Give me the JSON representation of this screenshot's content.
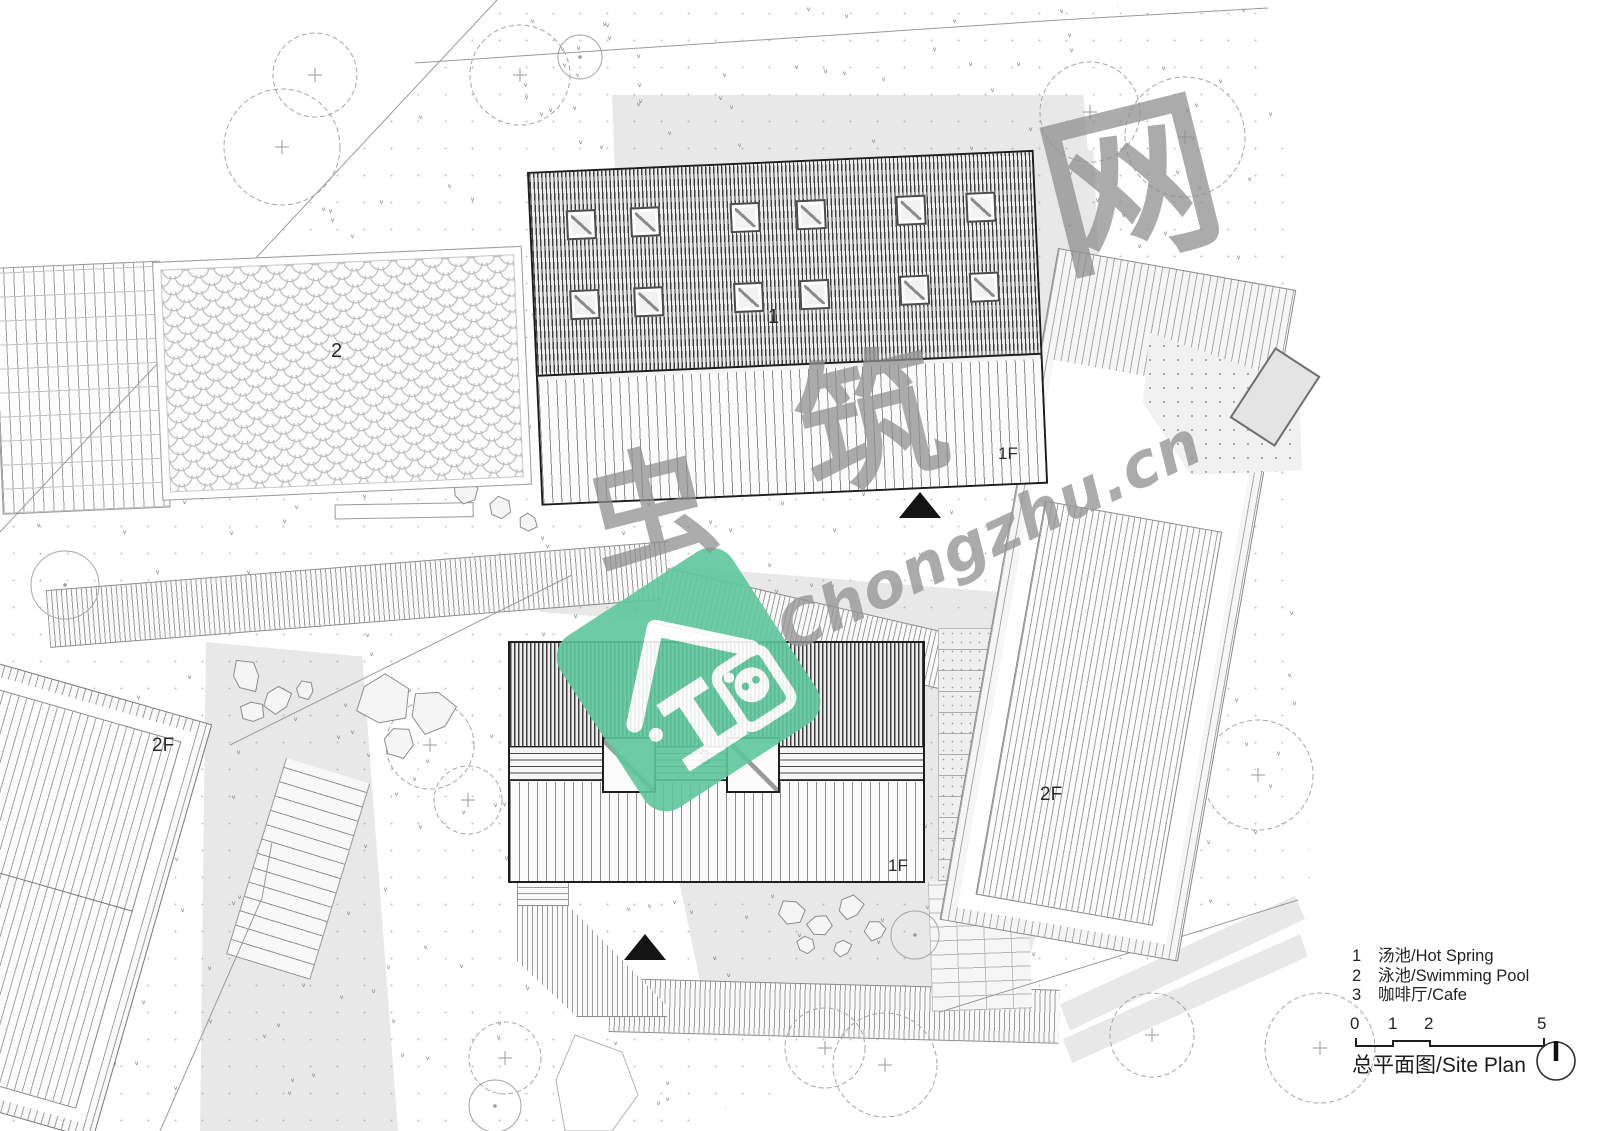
{
  "plan": {
    "buildings": {
      "hot_spring": {
        "number": "1",
        "floor": "1F"
      },
      "pool": {
        "number": "2"
      },
      "cafe": {
        "number": "3",
        "floor": "1F"
      },
      "west_building": {
        "floor": "2F"
      },
      "east_building": {
        "floor": "2F"
      }
    },
    "legend": {
      "items": [
        {
          "num": "1",
          "label": "汤池/Hot Spring"
        },
        {
          "num": "2",
          "label": "泳池/Swimming Pool"
        },
        {
          "num": "3",
          "label": "咖啡厅/Cafe"
        }
      ],
      "scale_ticks": [
        "0",
        "1",
        "2",
        "5"
      ],
      "title": "总平面图/Site Plan"
    },
    "watermark": {
      "char1": "虫",
      "char2": "筑",
      "char3": "网",
      "site": "Chongzhu.cn",
      "logo_color": "#5ec79c"
    }
  }
}
